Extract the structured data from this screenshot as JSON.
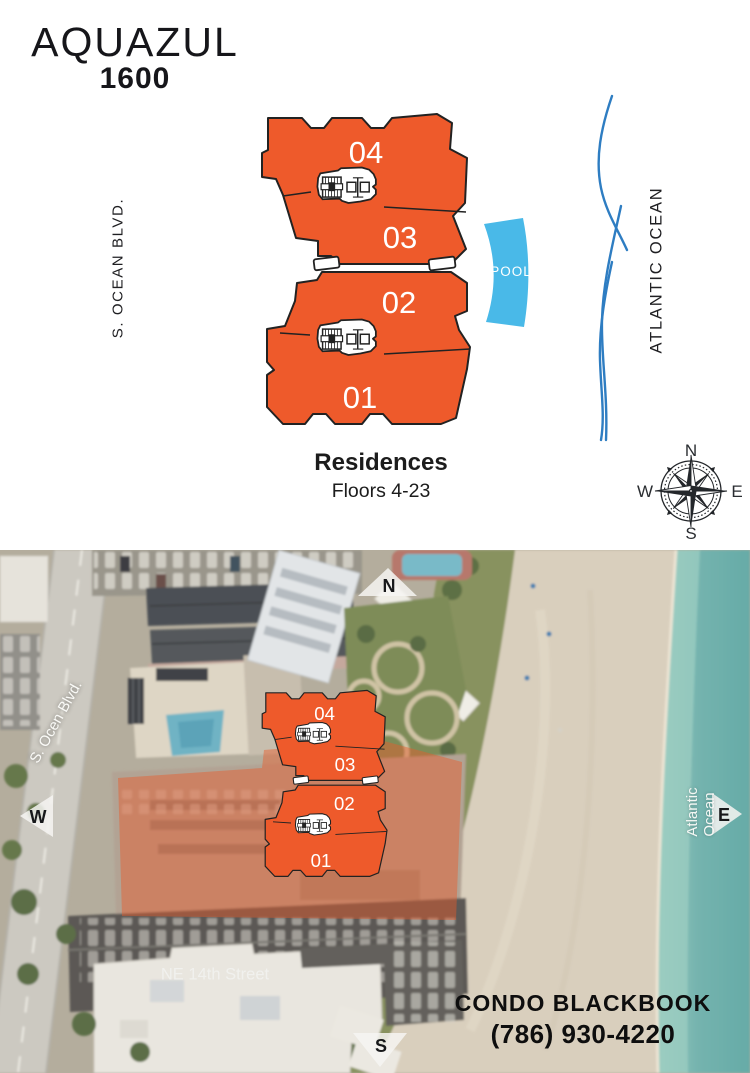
{
  "logo": {
    "name": "AQUAZUL",
    "number": "1600"
  },
  "site_plan": {
    "street_label": "S. OCEAN BLVD.",
    "ocean_label": "ATLANTIC OCEAN",
    "pool_label": "POOL",
    "caption": {
      "title": "Residences",
      "subtitle": "Floors 4-23"
    },
    "compass": {
      "n": "N",
      "e": "E",
      "s": "S",
      "w": "W"
    }
  },
  "units": {
    "list": [
      "04",
      "03",
      "02",
      "01"
    ]
  },
  "satellite": {
    "street_label": "S. Ocen Blvd.",
    "ocean_label": "Atlantic Ocean",
    "cross_street_label": "NE 14th Street",
    "markers": {
      "n": "N",
      "w": "W",
      "e": "E",
      "s": "S"
    },
    "branding": {
      "company": "CONDO BLACKBOOK",
      "phone": "(786) 930-4220"
    }
  },
  "colors": {
    "accent_orange": "#EE5A2B",
    "pool_blue": "#49B9E8",
    "wave_blue": "#2E7DC2",
    "ocean_teal": "#74B3AE"
  }
}
